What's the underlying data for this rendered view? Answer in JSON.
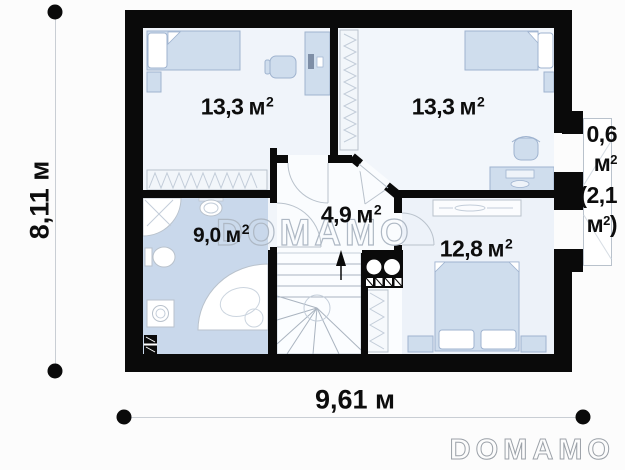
{
  "watermark_text": "DOMAMO",
  "brand_logo": "DOMAMO",
  "dimensions": {
    "vertical": "8,11 м",
    "horizontal": "9,61 м"
  },
  "rooms": {
    "top_left": {
      "value": "13,3",
      "unit": "м",
      "sup": "2"
    },
    "top_right": {
      "value": "13,3",
      "unit": "м",
      "sup": "2"
    },
    "hall": {
      "value": "4,9",
      "unit": "м",
      "sup": "2"
    },
    "bathroom": {
      "value": "9,0",
      "unit": "м",
      "sup": "2"
    },
    "bedroom": {
      "value": "12,8",
      "unit": "м",
      "sup": "2"
    }
  },
  "balcony": {
    "line1": "0,6",
    "line2_unit": "м",
    "line2_sup": "2",
    "line3": "(2,1",
    "line4_unit": "м",
    "line4_sup": "2",
    "line4_close": ")"
  },
  "colors": {
    "wall": "#0a0a0a",
    "room_floor": "#f1f5fa",
    "bathroom_floor": "#c9d8eb",
    "furniture_fill": "#cfdded",
    "furniture_stroke": "#9fb3cf",
    "thin_line": "#b9c2cc"
  },
  "icons": [
    "single-bed-icon",
    "double-bed-icon",
    "nightstand-icon",
    "wardrobe-icon",
    "desk-icon",
    "office-chair-icon",
    "dresser-icon",
    "shower-icon",
    "washbasin-icon",
    "toilet-icon",
    "washing-machine-icon",
    "corner-bathtub-icon",
    "radiator-icon",
    "staircase-icon",
    "stair-direction-arrow-icon",
    "chimney-flue-icon"
  ]
}
